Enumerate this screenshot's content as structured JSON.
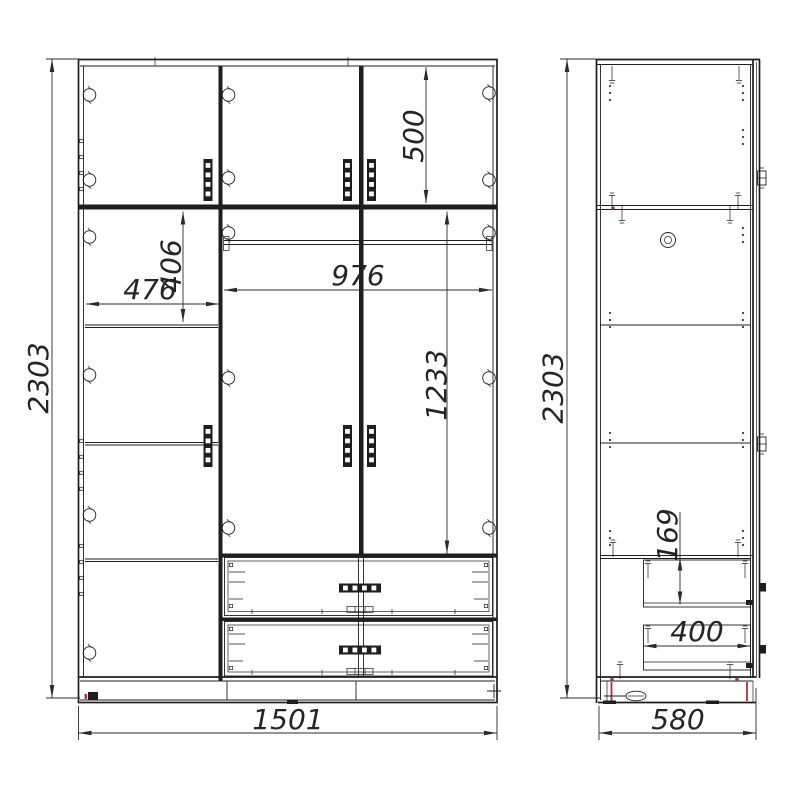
{
  "front": {
    "overall_height": "2303",
    "overall_width": "1501",
    "upper_door_height": "500",
    "left_shelf_offset": "406",
    "left_section_width": "476",
    "center_section_width": "976",
    "door_height": "1233"
  },
  "side": {
    "overall_height": "2303",
    "drawer_front_height": "169",
    "drawer_depth": "400",
    "overall_depth": "580"
  },
  "colors": {
    "line": "#1e1e1e",
    "accent_red": "#b03333",
    "background": "#ffffff"
  }
}
